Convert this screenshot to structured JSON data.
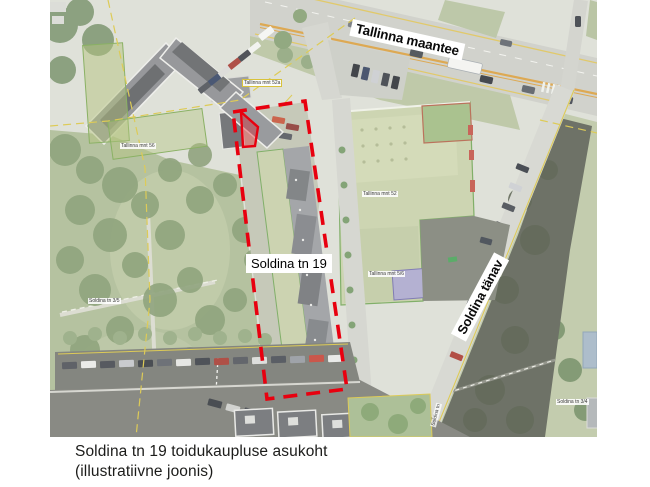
{
  "map": {
    "street_labels": {
      "tallinna_maantee": "Tallinna maantee",
      "soldina_tanav": "Soldina tänav"
    },
    "site_label": "Soldina tn 19",
    "parcel_labels": {
      "tallinna_mnt_52a": "Tallinna mnt 52a",
      "tallinna_mnt_52": "Tallinna mnt 52",
      "tallinna_mnt_5_6": "Tallinna mnt 5/6",
      "tallinna_mnt_56": "Tallinna mnt 56",
      "soldina_tn_3_5": "Soldina tn 3/5",
      "soldina_tn_3_4": "Soldina tn 3/4",
      "soldina_tn_road": "Soldina tn"
    },
    "colors": {
      "site_boundary_red": "#e8000f",
      "cadastral_yellow": "#d8c23a",
      "parcel_green_outline": "#6ba24f"
    }
  },
  "caption": {
    "line1": "Soldina tn 19 toidukaupluse asukoht",
    "line2": "(illustratiivne joonis)"
  }
}
